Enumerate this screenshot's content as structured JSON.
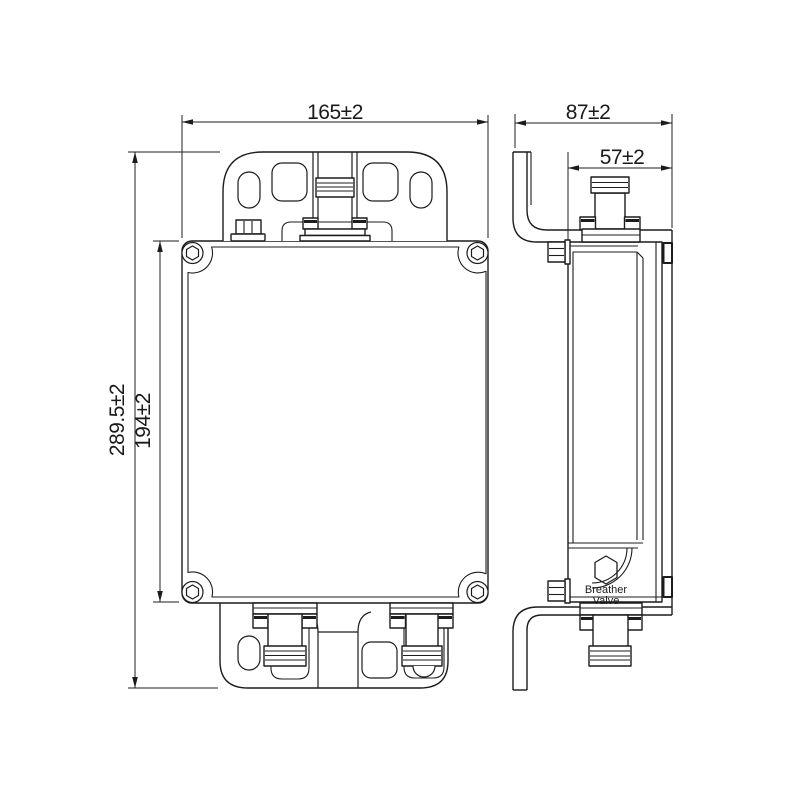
{
  "drawing": {
    "background": "#ffffff",
    "line_color": "#1c1c1c",
    "front_view": {
      "width_dim": "165±2",
      "overall_height_dim": "289.5±2",
      "body_height_dim": "194±2"
    },
    "side_view": {
      "overall_depth_dim": "87±2",
      "body_depth_dim": "57±2",
      "breather_valve": {
        "line1": "Breather",
        "line2": "Valve"
      }
    }
  }
}
